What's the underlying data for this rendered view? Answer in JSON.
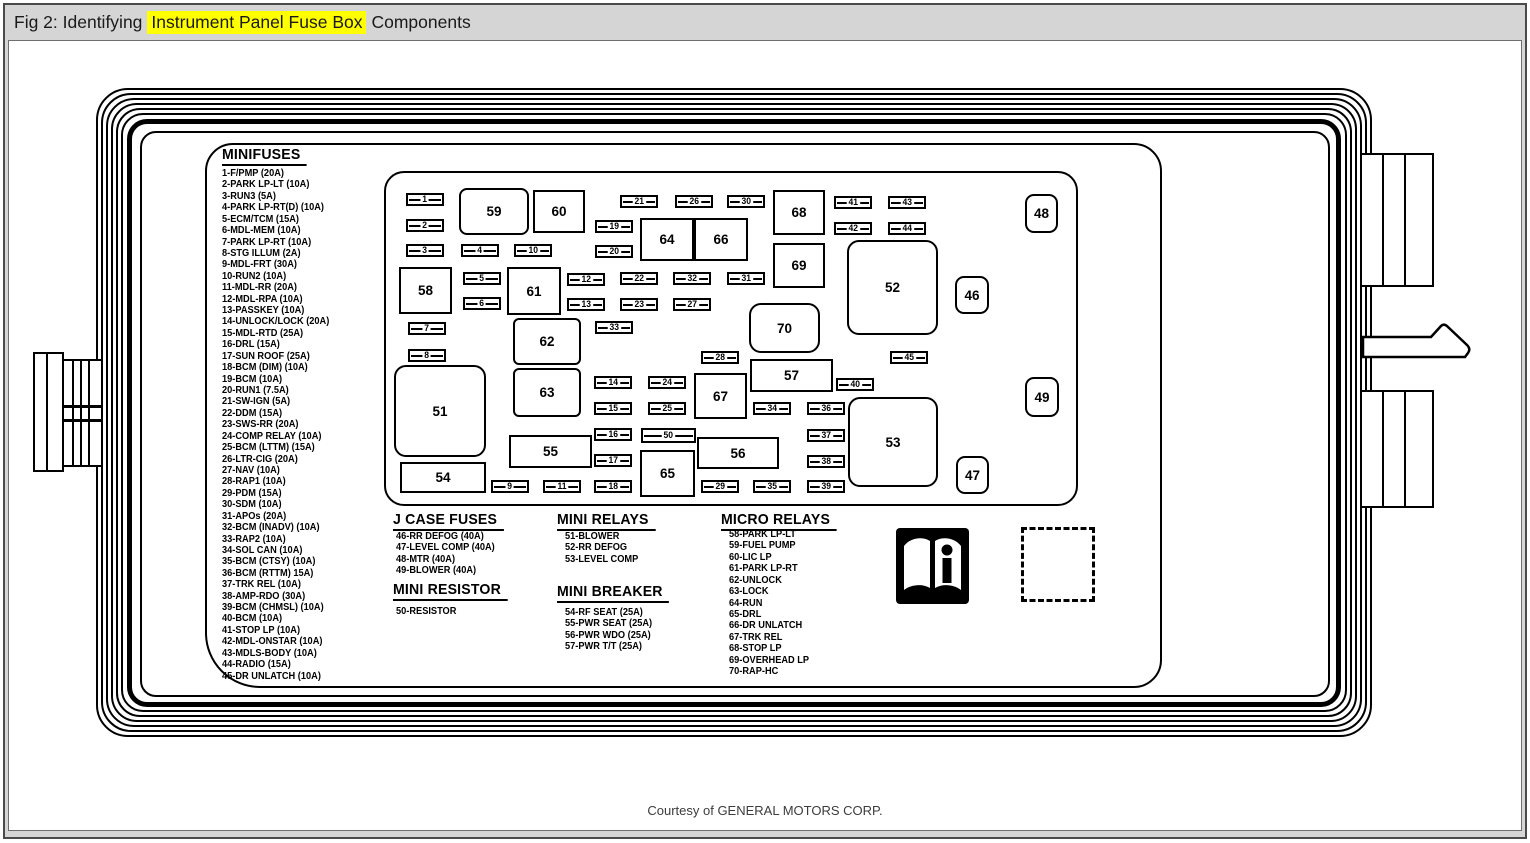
{
  "header": {
    "title_prefix": "Fig 2: Identifying",
    "title_highlight": "Instrument Panel Fuse Box",
    "title_suffix": "Components",
    "highlight_color": "#ffff00"
  },
  "footer": {
    "credit": "Courtesy of GENERAL MOTORS CORP."
  },
  "icons": {
    "manual_info": "open-book-info-icon",
    "empty_slot": "dashed-placeholder-box"
  },
  "legend": {
    "minifuses": {
      "title": "MINIFUSES",
      "items": [
        "1-F/PMP (20A)",
        "2-PARK LP-LT (10A)",
        "3-RUN3 (5A)",
        "4-PARK LP-RT(D) (10A)",
        "5-ECM/TCM (15A)",
        "6-MDL-MEM (10A)",
        "7-PARK LP-RT (10A)",
        "8-STG ILLUM (2A)",
        "9-MDL-FRT (30A)",
        "10-RUN2 (10A)",
        "11-MDL-RR (20A)",
        "12-MDL-RPA (10A)",
        "13-PASSKEY (10A)",
        "14-UNLOCK/LOCK (20A)",
        "15-MDL-RTD (25A)",
        "16-DRL (15A)",
        "17-SUN ROOF (25A)",
        "18-BCM (DIM) (10A)",
        "19-BCM (10A)",
        "20-RUN1 (7.5A)",
        "21-SW-IGN (5A)",
        "22-DDM (15A)",
        "23-SWS-RR (20A)",
        "24-COMP RELAY (10A)",
        "25-BCM (LTTM) (15A)",
        "26-LTR-CIG (20A)",
        "27-NAV (10A)",
        "28-RAP1 (10A)",
        "29-PDM (15A)",
        "30-SDM (10A)",
        "31-APOs (20A)",
        "32-BCM (INADV) (10A)",
        "33-RAP2 (10A)",
        "34-SOL CAN (10A)",
        "35-BCM (CTSY) (10A)",
        "36-BCM (RTTM) 15A)",
        "37-TRK REL (10A)",
        "38-AMP-RDO (30A)",
        "39-BCM (CHMSL) (10A)",
        "40-BCM (10A)",
        "41-STOP LP (10A)",
        "42-MDL-ONSTAR (10A)",
        "43-MDLS-BODY (10A)",
        "44-RADIO (15A)",
        "45-DR UNLATCH (10A)"
      ]
    },
    "jcase": {
      "title": "J CASE FUSES",
      "items": [
        "46-RR DEFOG (40A)",
        "47-LEVEL COMP (40A)",
        "48-MTR (40A)",
        "49-BLOWER (40A)"
      ]
    },
    "mini_resistor": {
      "title": "MINI RESISTOR",
      "items": [
        "50-RESISTOR"
      ]
    },
    "mini_relays": {
      "title": "MINI RELAYS",
      "items": [
        "51-BLOWER",
        "52-RR DEFOG",
        "53-LEVEL COMP"
      ]
    },
    "mini_breaker": {
      "title": "MINI BREAKER",
      "items": [
        "54-RF SEAT (25A)",
        "55-PWR SEAT (25A)",
        "56-PWR WDO (25A)",
        "57-PWR T/T (25A)"
      ]
    },
    "micro_relays": {
      "title": "MICRO RELAYS",
      "items": [
        "58-PARK LP-LT",
        "59-FUEL PUMP",
        "60-LIC LP",
        "61-PARK LP-RT",
        "62-UNLOCK",
        "63-LOCK",
        "64-RUN",
        "65-DRL",
        "66-DR UNLATCH",
        "67-TRK REL",
        "68-STOP LP",
        "69-OVERHEAD LP",
        "70-RAP-HC"
      ]
    }
  },
  "fusebox": {
    "small_fuses": [
      {
        "n": "1",
        "x": 406,
        "y": 193
      },
      {
        "n": "2",
        "x": 406,
        "y": 219
      },
      {
        "n": "3",
        "x": 406,
        "y": 244
      },
      {
        "n": "4",
        "x": 461,
        "y": 244
      },
      {
        "n": "10",
        "x": 514,
        "y": 244
      },
      {
        "n": "5",
        "x": 463,
        "y": 272
      },
      {
        "n": "6",
        "x": 463,
        "y": 297
      },
      {
        "n": "7",
        "x": 408,
        "y": 322
      },
      {
        "n": "8",
        "x": 408,
        "y": 349
      },
      {
        "n": "9",
        "x": 491,
        "y": 480
      },
      {
        "n": "11",
        "x": 543,
        "y": 480
      },
      {
        "n": "12",
        "x": 567,
        "y": 273
      },
      {
        "n": "13",
        "x": 567,
        "y": 298
      },
      {
        "n": "14",
        "x": 594,
        "y": 376
      },
      {
        "n": "15",
        "x": 594,
        "y": 402
      },
      {
        "n": "16",
        "x": 594,
        "y": 428
      },
      {
        "n": "17",
        "x": 594,
        "y": 454
      },
      {
        "n": "18",
        "x": 594,
        "y": 480
      },
      {
        "n": "19",
        "x": 595,
        "y": 220
      },
      {
        "n": "20",
        "x": 595,
        "y": 245
      },
      {
        "n": "21",
        "x": 620,
        "y": 195
      },
      {
        "n": "22",
        "x": 620,
        "y": 272
      },
      {
        "n": "23",
        "x": 620,
        "y": 298
      },
      {
        "n": "24",
        "x": 648,
        "y": 376
      },
      {
        "n": "25",
        "x": 648,
        "y": 402
      },
      {
        "n": "26",
        "x": 675,
        "y": 195
      },
      {
        "n": "27",
        "x": 673,
        "y": 298
      },
      {
        "n": "28",
        "x": 701,
        "y": 351
      },
      {
        "n": "29",
        "x": 701,
        "y": 480
      },
      {
        "n": "30",
        "x": 727,
        "y": 195
      },
      {
        "n": "31",
        "x": 727,
        "y": 272
      },
      {
        "n": "32",
        "x": 673,
        "y": 272
      },
      {
        "n": "33",
        "x": 595,
        "y": 321
      },
      {
        "n": "34",
        "x": 753,
        "y": 402
      },
      {
        "n": "35",
        "x": 753,
        "y": 480
      },
      {
        "n": "36",
        "x": 807,
        "y": 402
      },
      {
        "n": "37",
        "x": 807,
        "y": 429
      },
      {
        "n": "38",
        "x": 807,
        "y": 455
      },
      {
        "n": "39",
        "x": 807,
        "y": 480
      },
      {
        "n": "40",
        "x": 836,
        "y": 378
      },
      {
        "n": "41",
        "x": 834,
        "y": 196
      },
      {
        "n": "42",
        "x": 834,
        "y": 222
      },
      {
        "n": "43",
        "x": 888,
        "y": 196
      },
      {
        "n": "44",
        "x": 888,
        "y": 222
      },
      {
        "n": "45",
        "x": 890,
        "y": 351
      },
      {
        "n": "50",
        "x": 641,
        "y": 428,
        "w": 55,
        "h": 15
      }
    ],
    "boxes": [
      {
        "n": "59",
        "x": 459,
        "y": 188,
        "w": 70,
        "h": 47,
        "r": 8
      },
      {
        "n": "60",
        "x": 533,
        "y": 190,
        "w": 52,
        "h": 43
      },
      {
        "n": "68",
        "x": 773,
        "y": 190,
        "w": 52,
        "h": 45
      },
      {
        "n": "64",
        "x": 640,
        "y": 218,
        "w": 54,
        "h": 43
      },
      {
        "n": "66",
        "x": 694,
        "y": 218,
        "w": 54,
        "h": 43
      },
      {
        "n": "69",
        "x": 773,
        "y": 243,
        "w": 52,
        "h": 45
      },
      {
        "n": "58",
        "x": 399,
        "y": 267,
        "w": 53,
        "h": 47
      },
      {
        "n": "61",
        "x": 507,
        "y": 267,
        "w": 54,
        "h": 48
      },
      {
        "n": "52",
        "x": 847,
        "y": 240,
        "w": 91,
        "h": 95,
        "r": 12
      },
      {
        "n": "46",
        "x": 955,
        "y": 276,
        "w": 34,
        "h": 38,
        "r": 9
      },
      {
        "n": "48",
        "x": 1025,
        "y": 194,
        "w": 33,
        "h": 39,
        "r": 9
      },
      {
        "n": "70",
        "x": 749,
        "y": 303,
        "w": 71,
        "h": 50,
        "r": 12
      },
      {
        "n": "62",
        "x": 513,
        "y": 318,
        "w": 68,
        "h": 47,
        "r": 6
      },
      {
        "n": "63",
        "x": 513,
        "y": 368,
        "w": 68,
        "h": 49,
        "r": 6
      },
      {
        "n": "51",
        "x": 394,
        "y": 365,
        "w": 92,
        "h": 92,
        "r": 12
      },
      {
        "n": "57",
        "x": 750,
        "y": 359,
        "w": 83,
        "h": 33
      },
      {
        "n": "67",
        "x": 694,
        "y": 373,
        "w": 53,
        "h": 46
      },
      {
        "n": "53",
        "x": 848,
        "y": 397,
        "w": 90,
        "h": 90,
        "r": 12
      },
      {
        "n": "49",
        "x": 1025,
        "y": 377,
        "w": 34,
        "h": 40,
        "r": 9
      },
      {
        "n": "55",
        "x": 509,
        "y": 435,
        "w": 83,
        "h": 33
      },
      {
        "n": "56",
        "x": 697,
        "y": 437,
        "w": 82,
        "h": 32
      },
      {
        "n": "65",
        "x": 640,
        "y": 450,
        "w": 55,
        "h": 47
      },
      {
        "n": "54",
        "x": 400,
        "y": 462,
        "w": 86,
        "h": 31
      },
      {
        "n": "47",
        "x": 956,
        "y": 456,
        "w": 33,
        "h": 38,
        "r": 9
      }
    ]
  }
}
